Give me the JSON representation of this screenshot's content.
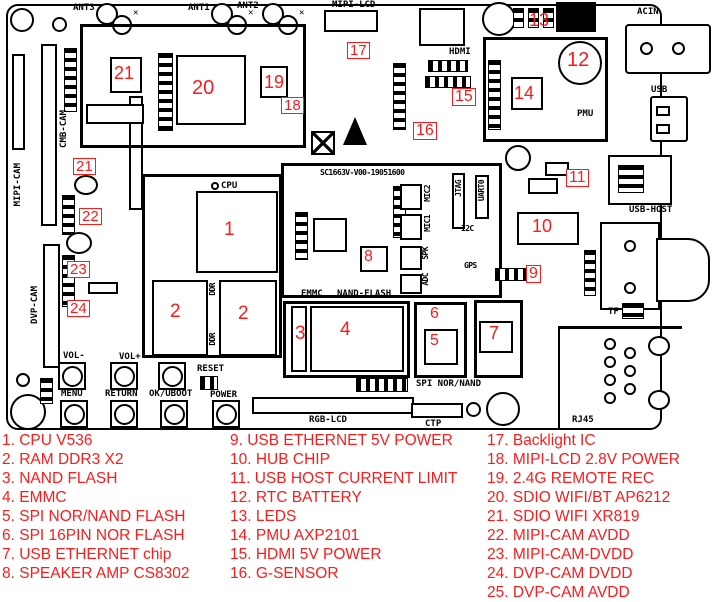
{
  "board": {
    "silkscreen_id": "SC1663V-V00-19051600",
    "labels": {
      "ant3": "ANT3",
      "ant1": "ANT1",
      "ant2": "ANT2",
      "mipi_lcd": "MIPI-LCD",
      "hdmi": "HDMI",
      "acin": "ACIN",
      "usb": "USB",
      "pmu": "PMU",
      "usb_host": "USB-HOST",
      "mipi_cam": "MIPI-CAM",
      "cmb_cam": "CMB-CAM",
      "dvp_cam": "DVP-CAM",
      "cpu": "CPU",
      "ddr": "DDR",
      "emmc": "EMMC",
      "nand_flash": "NAND-FLASH",
      "spi_nor_nand": "SPI NOR/NAND",
      "ctp": "CTP",
      "rgb_lcd": "RGB-LCD",
      "rj45": "RJ45",
      "tf": "TF",
      "mic2": "MIC2",
      "mic1": "MIC1",
      "spk": "SPK",
      "adc": "ADC",
      "jtag": "JTAG",
      "uart0": "UART0",
      "i2c": "I2C",
      "gps": "GPS",
      "vol_minus": "VOL-",
      "vol_plus": "VOL+",
      "reset": "RESET",
      "menu": "MENU",
      "return": "RETURN",
      "ok_uboot": "OK/UBOOT",
      "power": "POWER"
    },
    "markers": [
      "1",
      "2",
      "2",
      "3",
      "4",
      "5",
      "6",
      "7",
      "8",
      "9",
      "10",
      "11",
      "12",
      "13",
      "14",
      "15",
      "16",
      "17",
      "18",
      "19",
      "20",
      "21",
      "21",
      "22",
      "23",
      "24"
    ]
  },
  "legend": {
    "col1": [
      "1. CPU V536",
      "2. RAM DDR3 X2",
      "3. NAND FLASH",
      "4. EMMC",
      "5. SPI NOR/NAND FLASH",
      "6. SPI 16PIN NOR FLASH",
      "7. USB ETHERNET chip",
      "8. SPEAKER AMP CS8302"
    ],
    "col2": [
      "9. USB ETHERNET 5V POWER",
      "10. HUB CHIP",
      "11. USB HOST CURRENT LIMIT",
      "12. RTC BATTERY",
      "13. LEDS",
      "14. PMU AXP2101",
      "15. HDMI 5V POWER",
      "16. G-SENSOR"
    ],
    "col3": [
      "17. Backlight IC",
      "18. MIPI-LCD 2.8V POWER",
      "19. 2.4G REMOTE REC",
      "20. SDIO WIFI/BT AP6212",
      "21. SDIO WIFI XR819",
      "22. MIPI-CAM AVDD",
      "23. MIPI-CAM-DVDD",
      "24. DVP-CAM DVDD",
      "25. DVP-CAM AVDD"
    ]
  },
  "colors": {
    "annotation_red": "#ff1a1a",
    "line_black": "#000000",
    "board_bg": "#ffffff"
  }
}
